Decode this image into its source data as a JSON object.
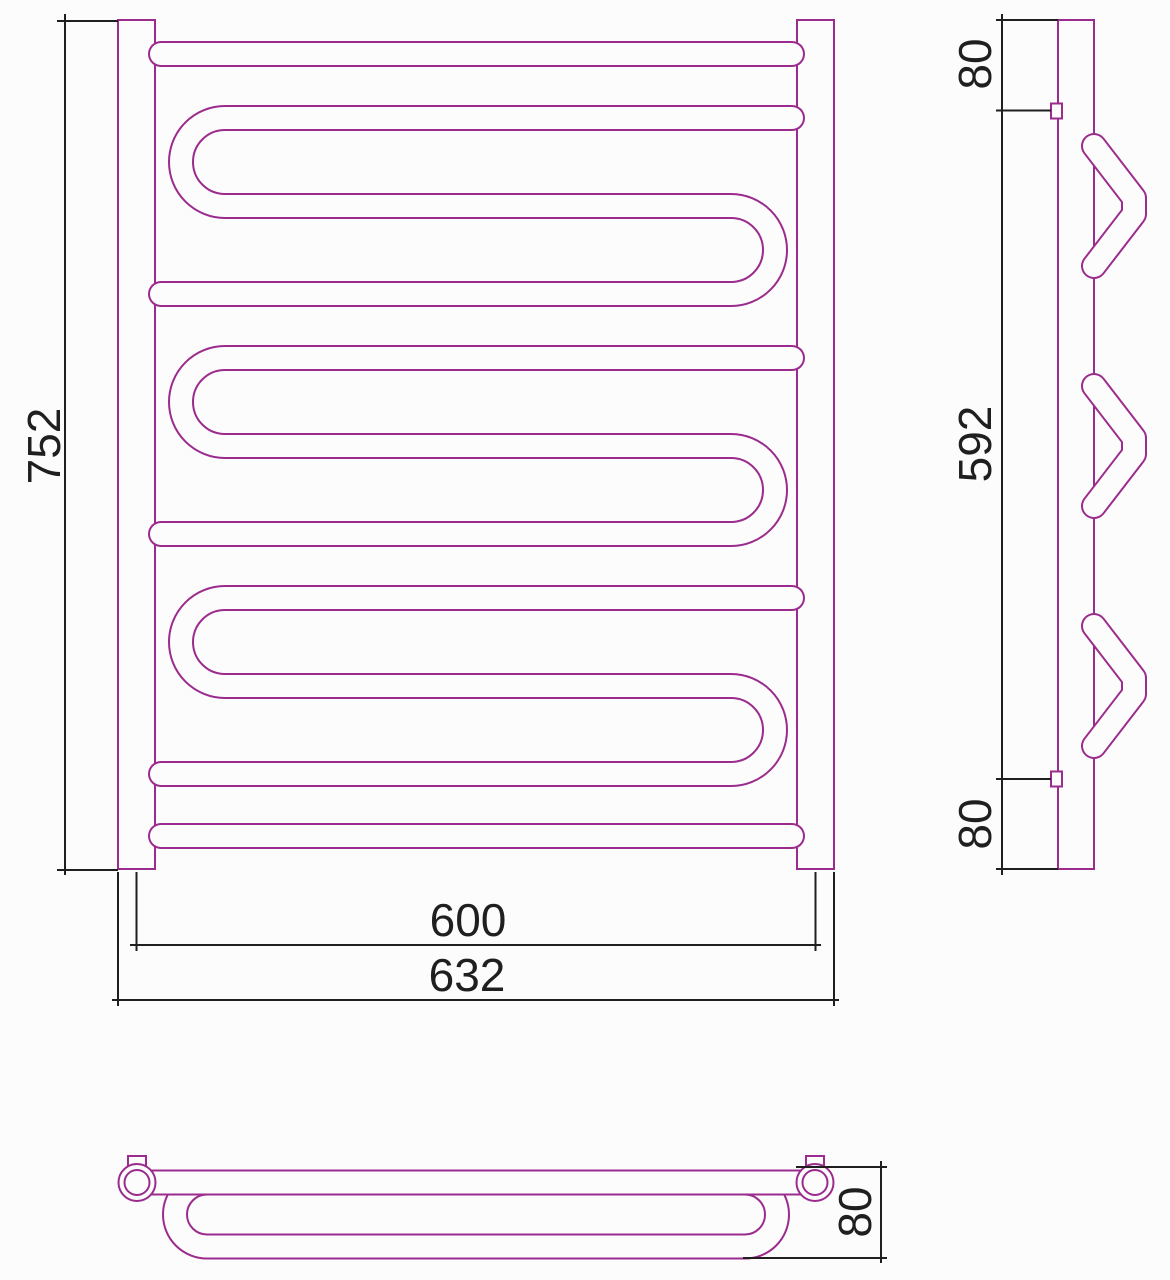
{
  "page": {
    "background": "#fcfcfc"
  },
  "drawing": {
    "subject": "serpentine-towel-rail-three-view-technical-drawing",
    "outline_color": "#9b2b8c",
    "dimension_color": "#1f1f1f",
    "front_view": {
      "height": "752",
      "connection_span": "600",
      "overall_width": "632"
    },
    "side_view": {
      "top_offset": "80",
      "connection_span": "592",
      "bottom_offset": "80"
    },
    "bottom_view": {
      "depth": "80"
    }
  }
}
